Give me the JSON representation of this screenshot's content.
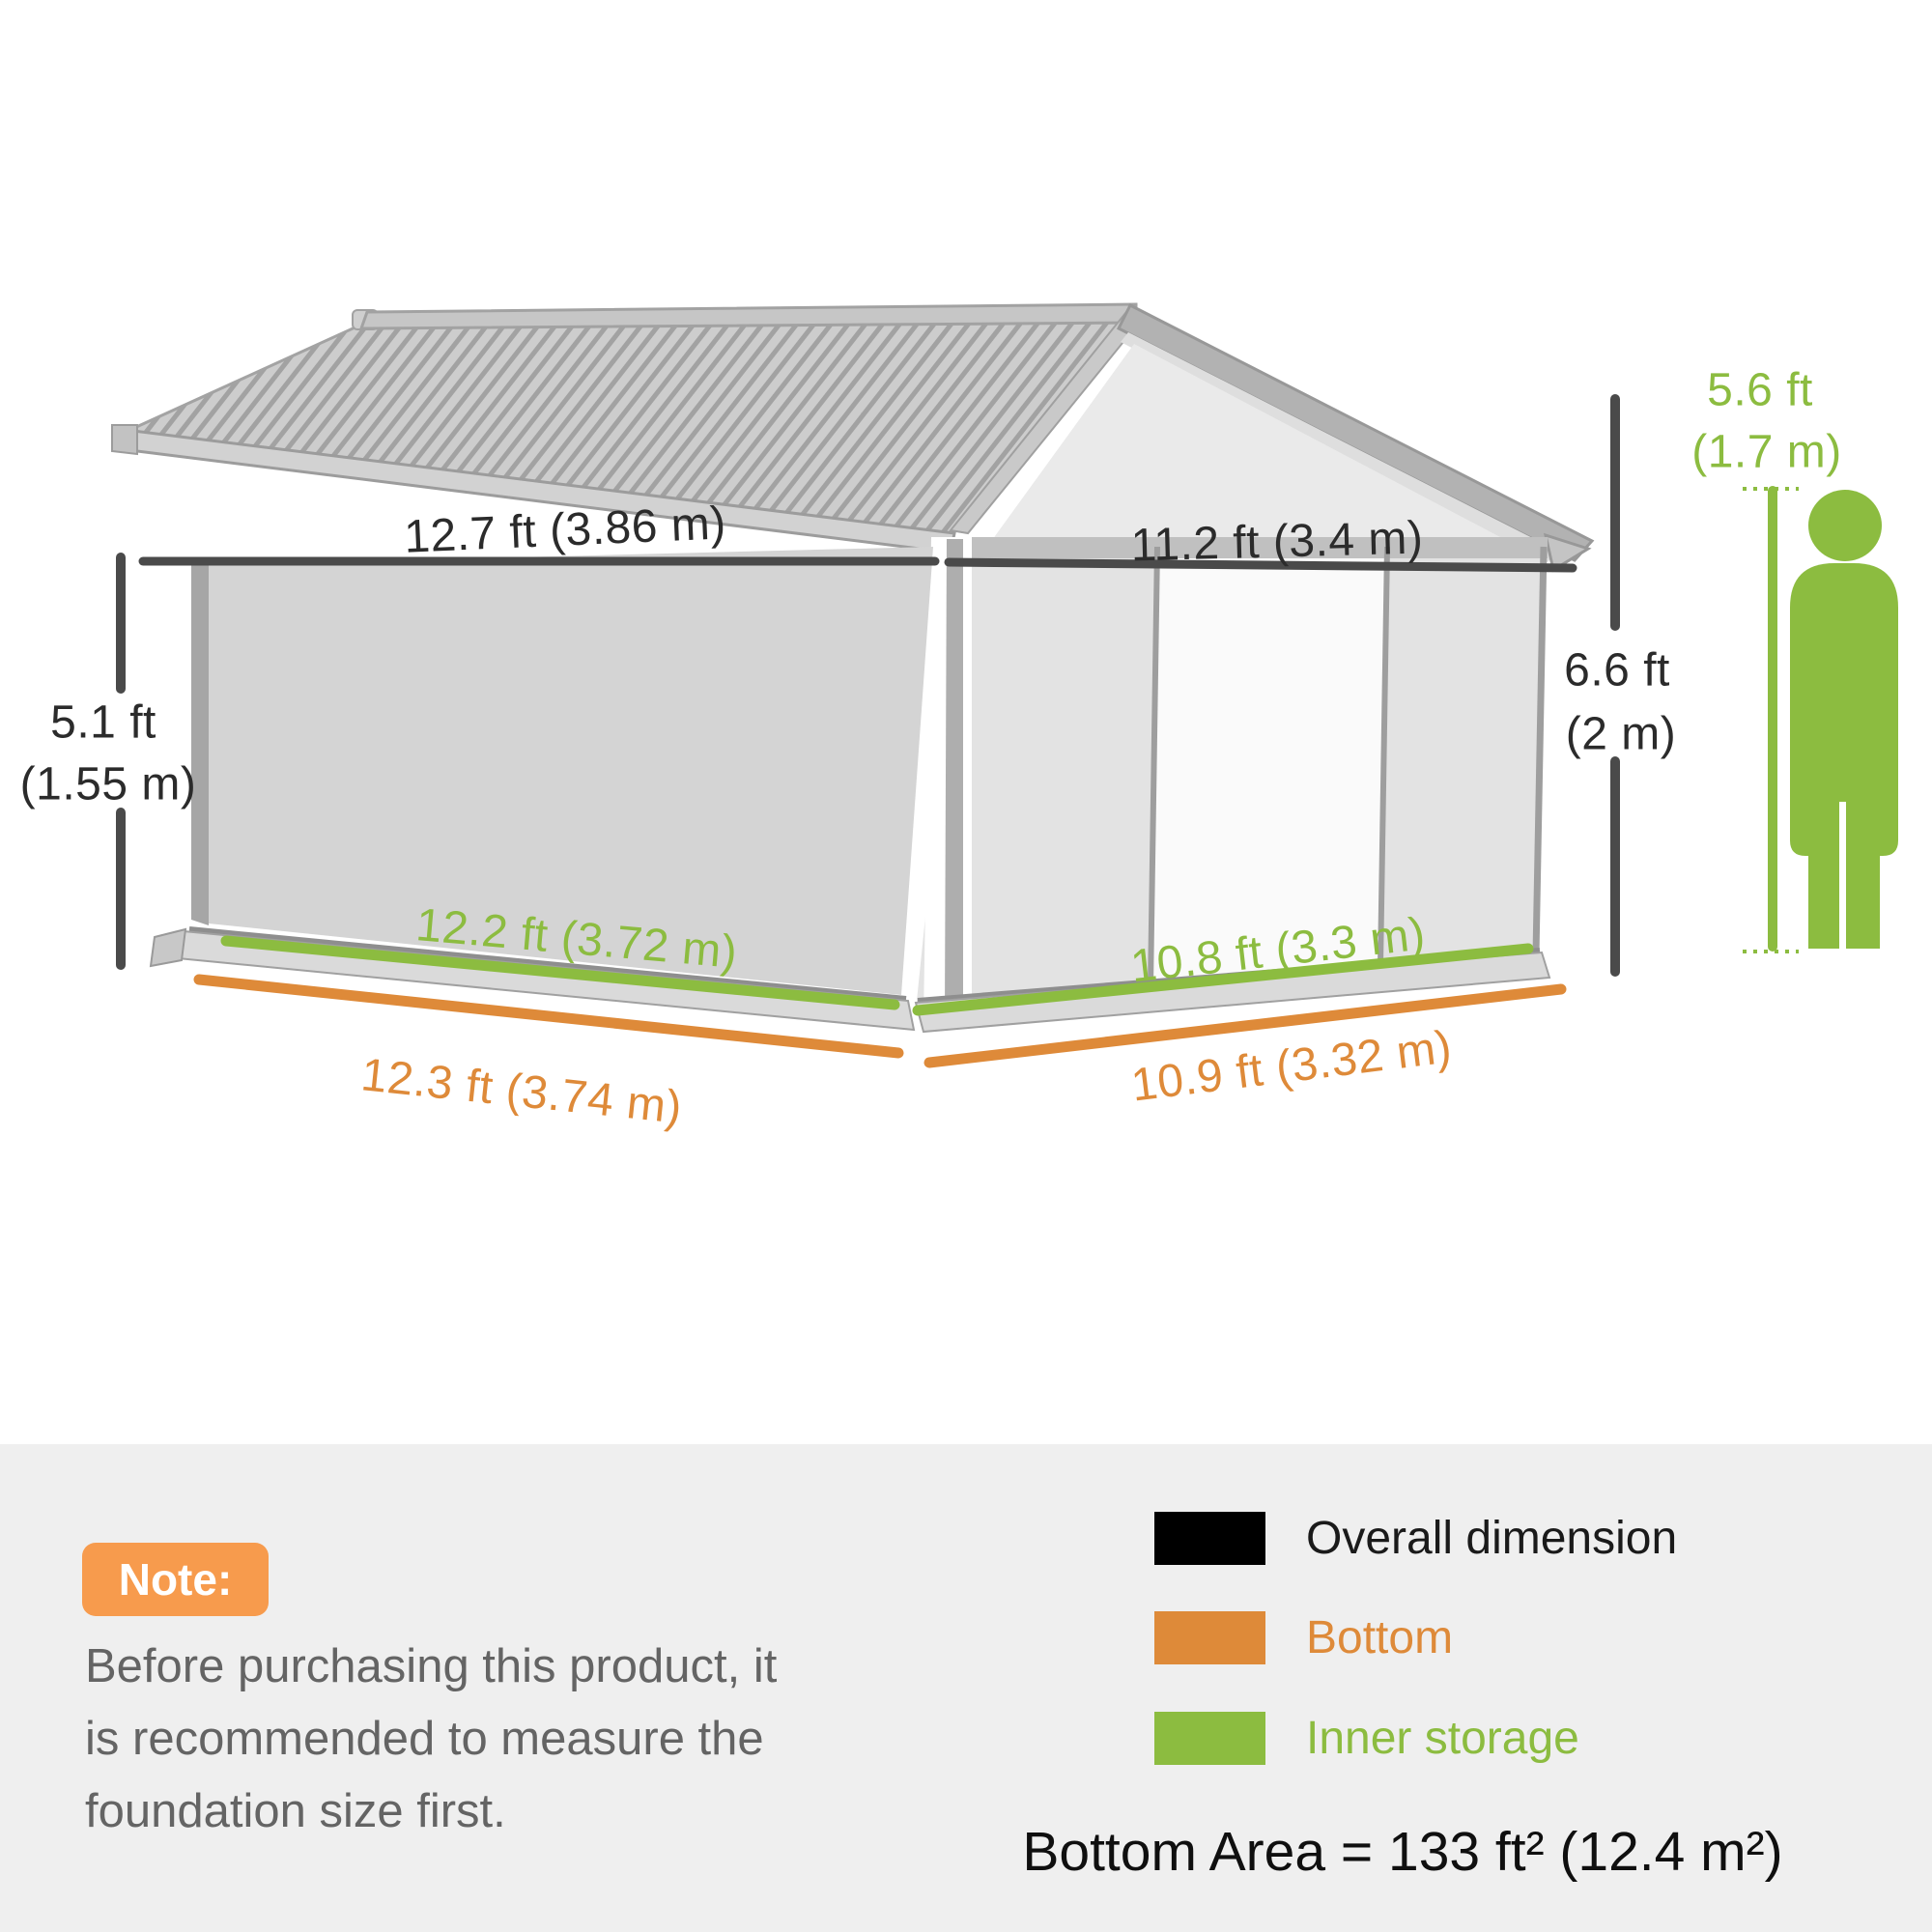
{
  "diagram": {
    "dimensions": {
      "roof_left": "12.7 ft (3.86 m)",
      "front_top": "11.2 ft (3.4 m)",
      "eave_height_line1": "5.1 ft",
      "eave_height_line2": "(1.55 m)",
      "wall_height_line1": "6.6 ft",
      "wall_height_line2": "(2 m)",
      "person_height_line1": "5.6 ft",
      "person_height_line2": "(1.7 m)",
      "inner_storage_side": "12.2 ft (3.72 m)",
      "bottom_side": "12.3 ft (3.74 m)",
      "inner_storage_front": "10.8 ft (3.3 m)",
      "bottom_front": "10.9 ft (3.32 m)"
    },
    "colors": {
      "overall_dimension_line": "#4a4a4a",
      "bottom_line": "#de8a39",
      "inner_storage_line": "#8cbc40",
      "person_silhouette": "#8cbc40"
    }
  },
  "note": {
    "badge_label": "Note:",
    "badge_color": "#f79b4d",
    "lines": [
      "Before purchasing this product, it",
      "is recommended to measure the",
      "foundation size first."
    ]
  },
  "legend": {
    "items": [
      {
        "label": "Overall dimension",
        "color": "#000000"
      },
      {
        "label": "Bottom",
        "color": "#de8a39"
      },
      {
        "label": "Inner storage",
        "color": "#8cbc40"
      }
    ]
  },
  "summary": {
    "bottom_area": "Bottom Area = 133 ft² (12.4 m²)"
  }
}
